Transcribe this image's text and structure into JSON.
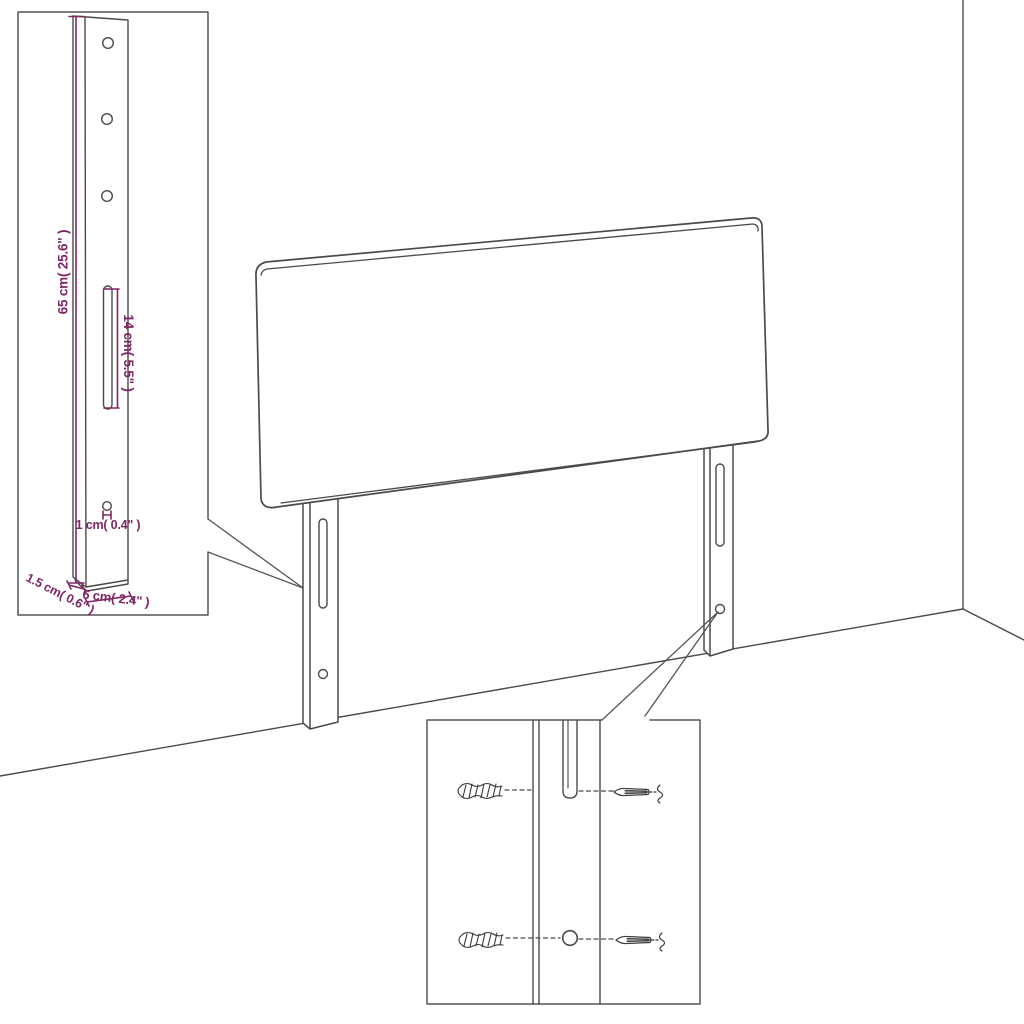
{
  "colors": {
    "line_art": "#4a4a4a",
    "inset_border": "#555555",
    "dimension_accent": "#7e2765"
  },
  "bracket_detail_inset": {
    "labels": {
      "height": "65 cm( 25.6\" )",
      "slot_length": "14 cm( 5.5\" )",
      "hole_diameter": "1 cm( 0.4\" )",
      "thickness": "1.5 cm( 0.6\" )",
      "width": "6 cm( 2.4\" )"
    }
  }
}
